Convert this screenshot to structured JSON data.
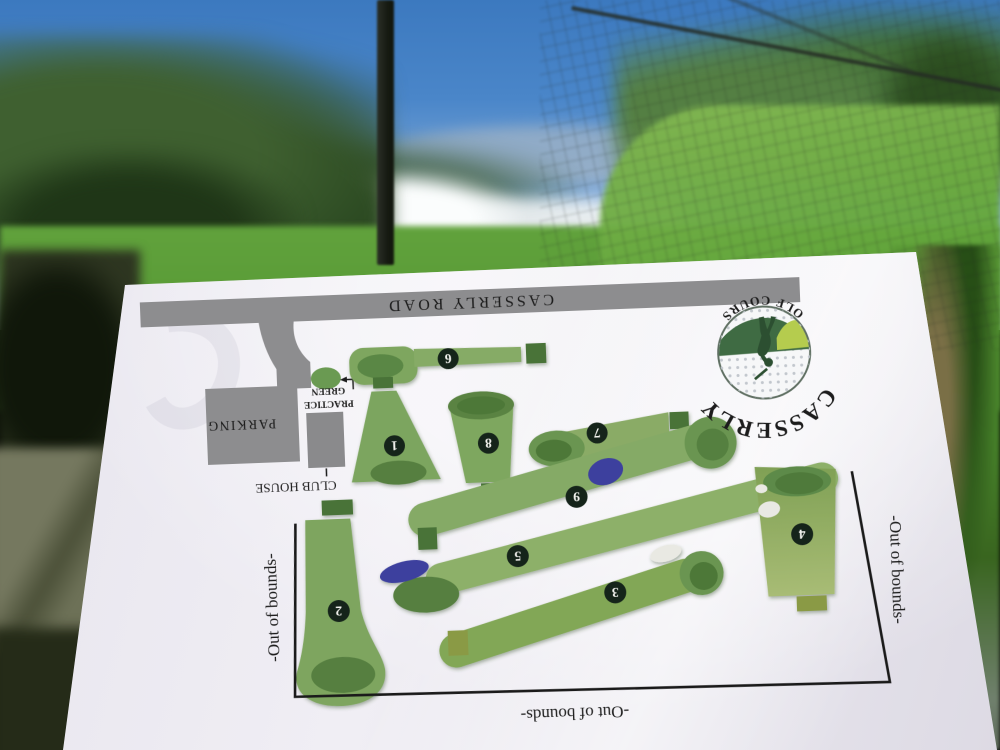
{
  "map": {
    "road_label": "CASSERLY ROAD",
    "parking_label": "PARKING",
    "club_house_label": "CLUB HOUSE",
    "practice_green_line1": "PRACTICE",
    "practice_green_line2": "GREEN",
    "out_of_bounds_label": "-Out of bounds-",
    "logo": {
      "name": "CASSERLY",
      "subtitle": "GOLF COURSE"
    },
    "holes": [
      {
        "number": "1"
      },
      {
        "number": "2"
      },
      {
        "number": "3",
        "bunker": true
      },
      {
        "number": "4",
        "bunker": true
      },
      {
        "number": "5",
        "water": true
      },
      {
        "number": "6"
      },
      {
        "number": "7"
      },
      {
        "number": "8"
      },
      {
        "number": "9",
        "water": true
      }
    ],
    "colors": {
      "paper": "#edeaf2",
      "road_gray": "#8d8d8f",
      "fairway_green": "#7ea65f",
      "putting_green": "#567f41",
      "dark_green": "#4d7839",
      "tee_box_green": "#4a7339",
      "olive_tee": "#8a9a45",
      "water_hazard_blue": "#3d3f9e",
      "sand_bunker": "#e9e9e3",
      "hole_marker": "#15241a",
      "boundary_line": "#1a1a1a",
      "logo_green": "#3c6d42",
      "sky_blue": "#4a86c9"
    }
  }
}
